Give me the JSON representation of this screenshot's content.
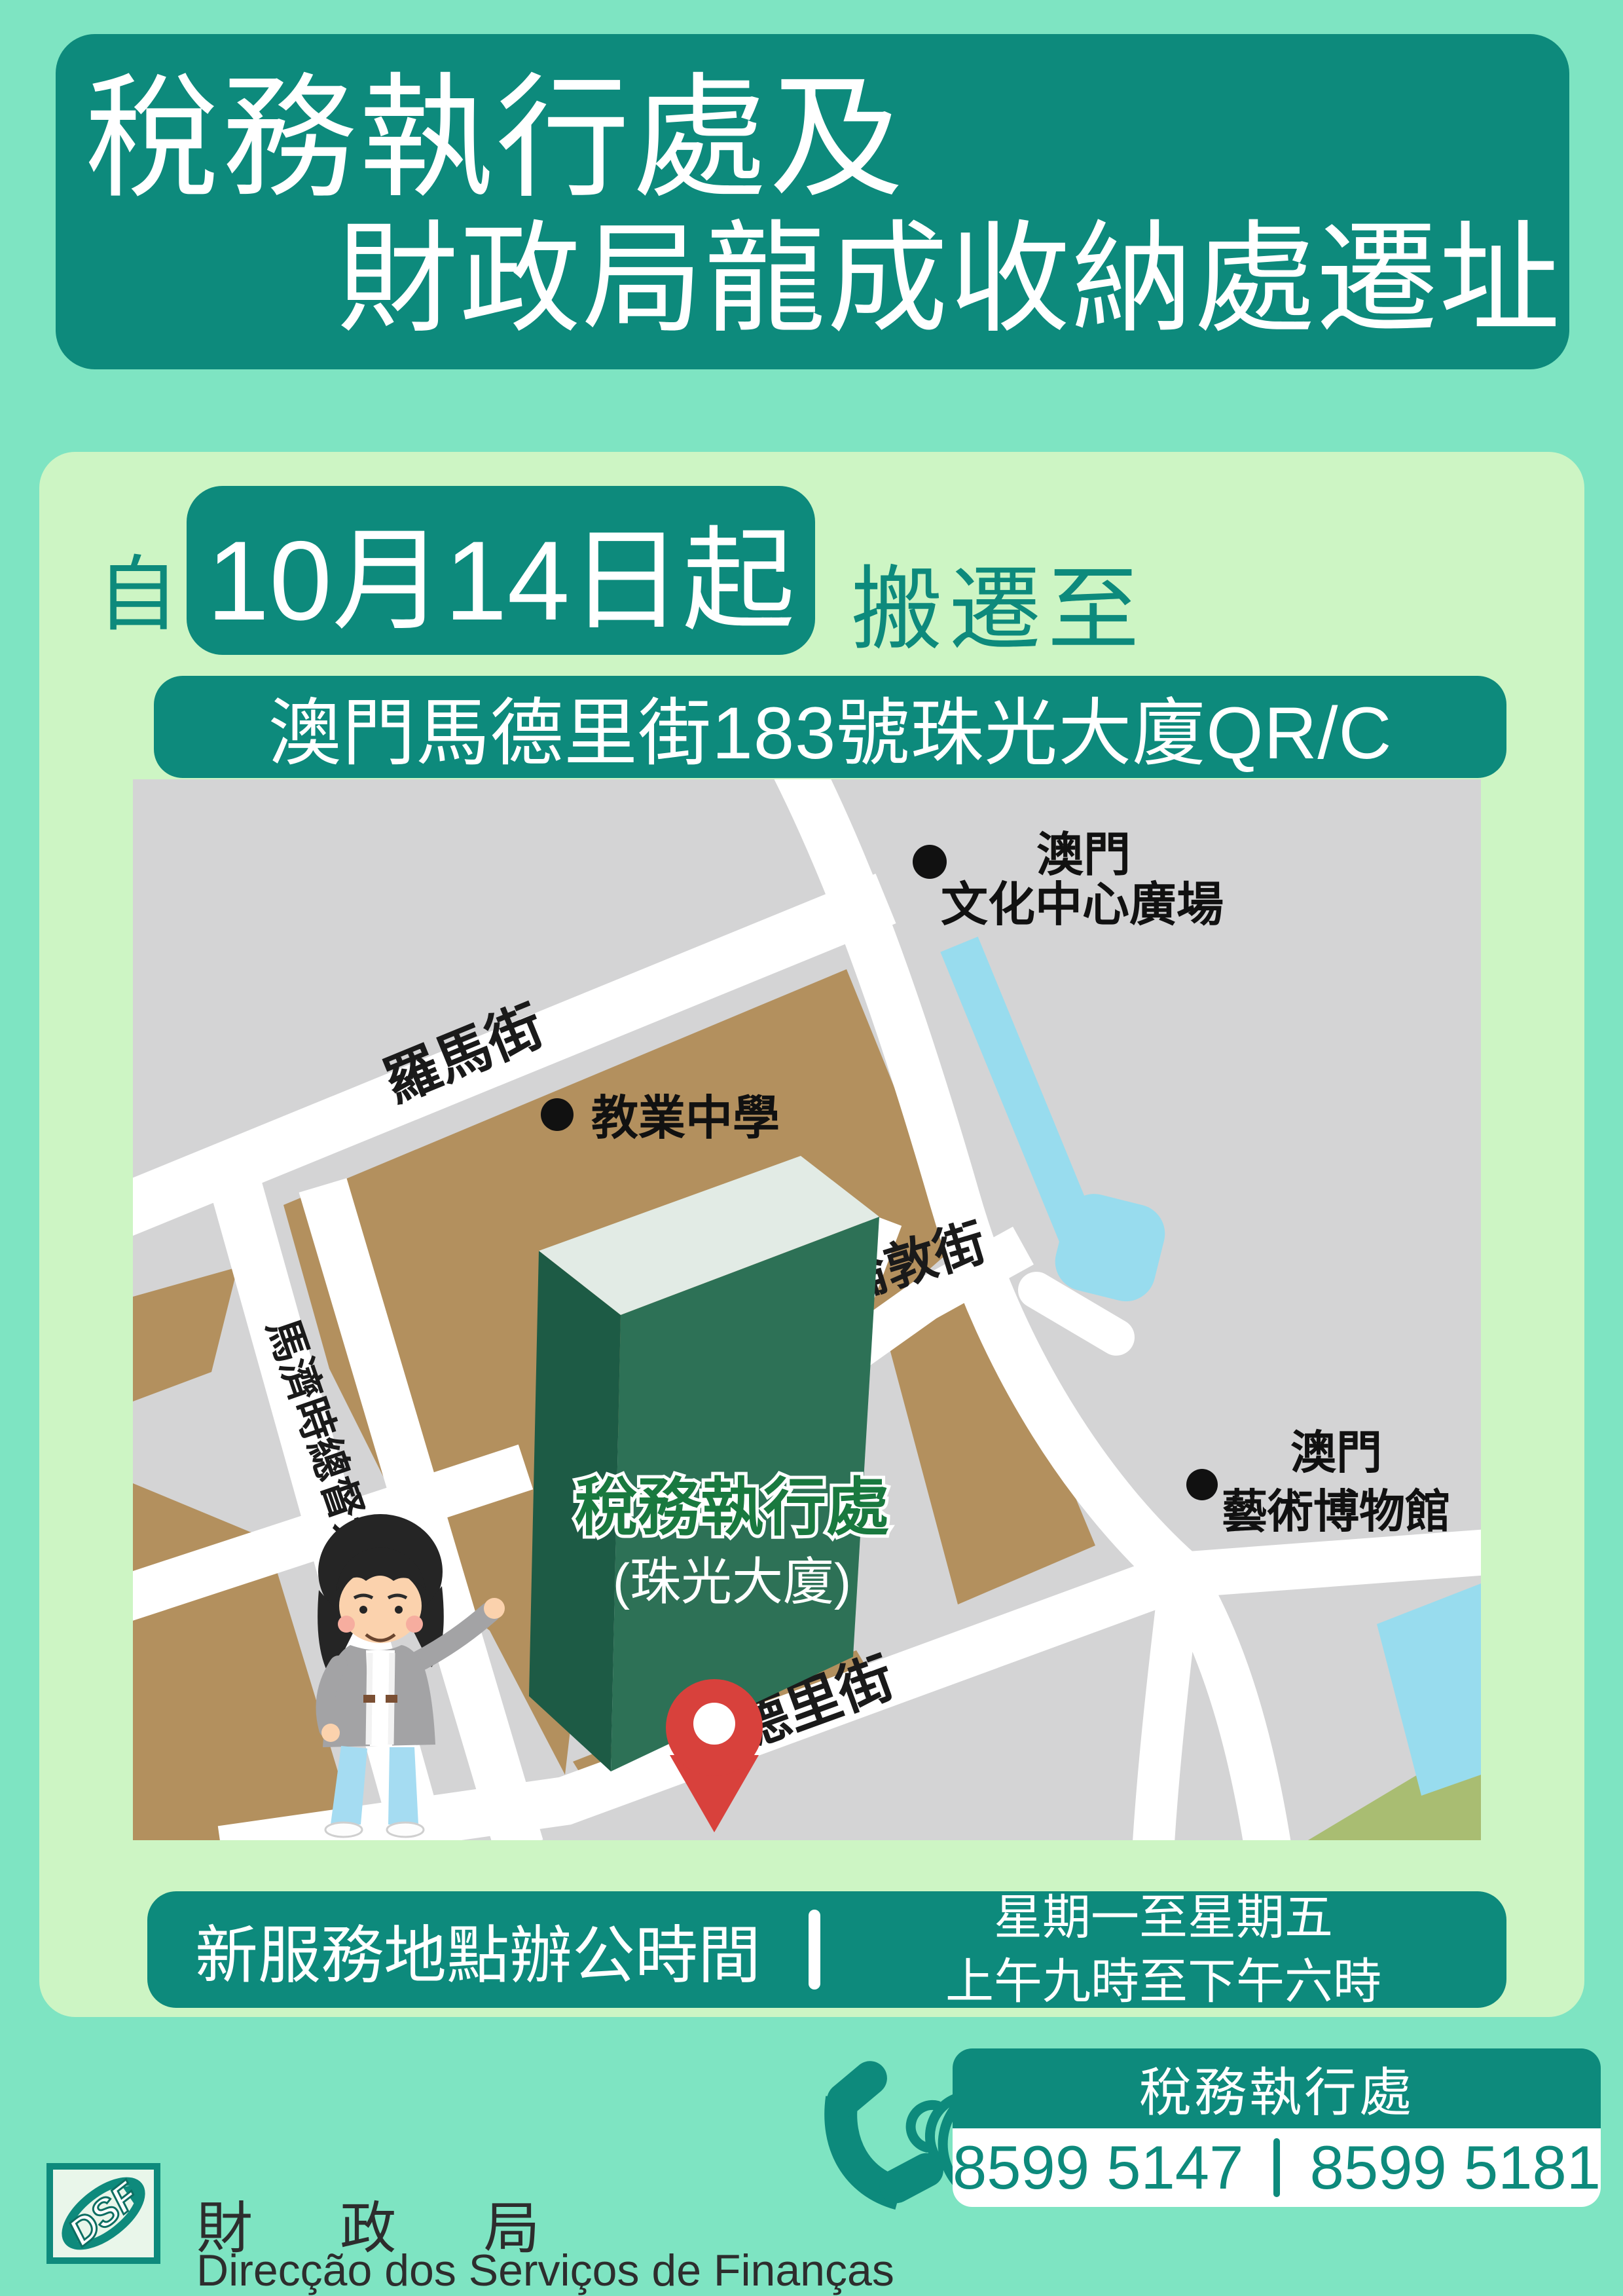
{
  "colors": {
    "teal": "#0d8a7c",
    "mint_background": "#7ee4c2",
    "panel_green": "#cdf5c4",
    "map_gray": "#d4d4d5",
    "block_tan": "#b3905e",
    "water_blue": "#98dcee",
    "park_olive": "#a9bd72",
    "building_roof": "#e2ebe5",
    "building_left": "#1d5b45",
    "building_right": "#2d7156",
    "pin_red": "#d8413c",
    "building_label_green": "#19793f"
  },
  "header": {
    "line1": "稅務執行處及",
    "line2": "財政局龍成收納處遷址"
  },
  "move": {
    "prefix": "自",
    "date": "10月14日起",
    "suffix": "搬遷至"
  },
  "address": "澳門馬德里街183號珠光大廈QR/C",
  "map": {
    "streets": {
      "roma": "羅馬街",
      "governor": "馬濟時總督大馬路",
      "london": "倫敦街",
      "madrid": "馬德里街"
    },
    "landmarks": {
      "cultural_line1": "澳門",
      "cultural_line2": "文化中心廣場",
      "school": "教業中學",
      "museum_line1": "澳門",
      "museum_line2": "藝術博物館"
    },
    "building": {
      "name": "稅務執行處",
      "alias": "(珠光大廈)"
    }
  },
  "hours": {
    "label": "新服務地點辦公時間",
    "days": "星期一至星期五",
    "time": "上午九時至下午六時"
  },
  "contact": {
    "department": "稅務執行處",
    "phone1": "8599 5147",
    "phone2": "8599 5181"
  },
  "footer": {
    "logo_text": "DSF",
    "org_zh": "財政局",
    "org_pt": "Direcção dos Serviços de Finanças"
  }
}
